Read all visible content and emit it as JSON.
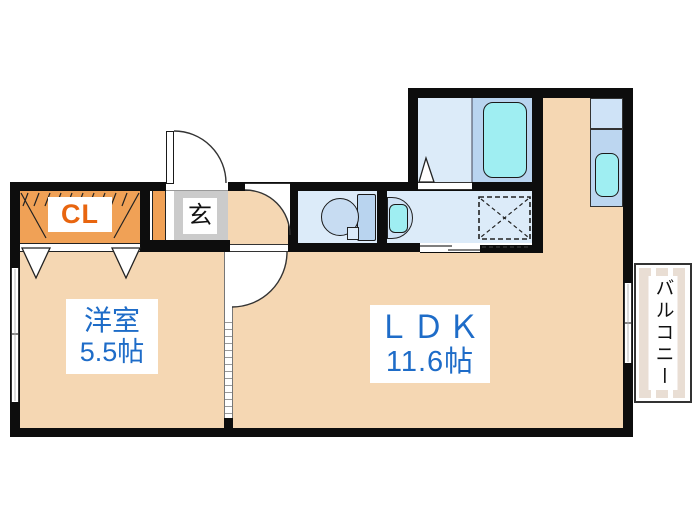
{
  "plan": {
    "closet": {
      "label": "CL"
    },
    "entrance": {
      "label": "玄"
    },
    "western_room": {
      "name": "洋室",
      "area": "5.5帖"
    },
    "ldk": {
      "name": "ＬＤＫ",
      "area": "11.6帖"
    },
    "balcony": {
      "label": "バルコニー"
    }
  },
  "colors": {
    "floor_peach": "#f5d7b3",
    "closet_orange": "#f0a156",
    "entrance_tile_gray": "#cbcbcb",
    "wet_room_light_blue": "#dcebf9",
    "fixture_blue": "#b9d4ef",
    "water_cyan": "#9feef2",
    "label_blue": "#1e6cc8",
    "label_orange": "#e8650f",
    "wall_black": "#0d0d0d",
    "balcony_stripe_beige": "#e9ded4"
  },
  "fixtures": {
    "bathtub": "bathtub-icon",
    "toilet": "toilet-icon",
    "wash_basin": "wash-basin-icon",
    "kitchen_sink": "kitchen-sink-icon",
    "washing_machine_space": "washing-machine-pan-icon"
  }
}
